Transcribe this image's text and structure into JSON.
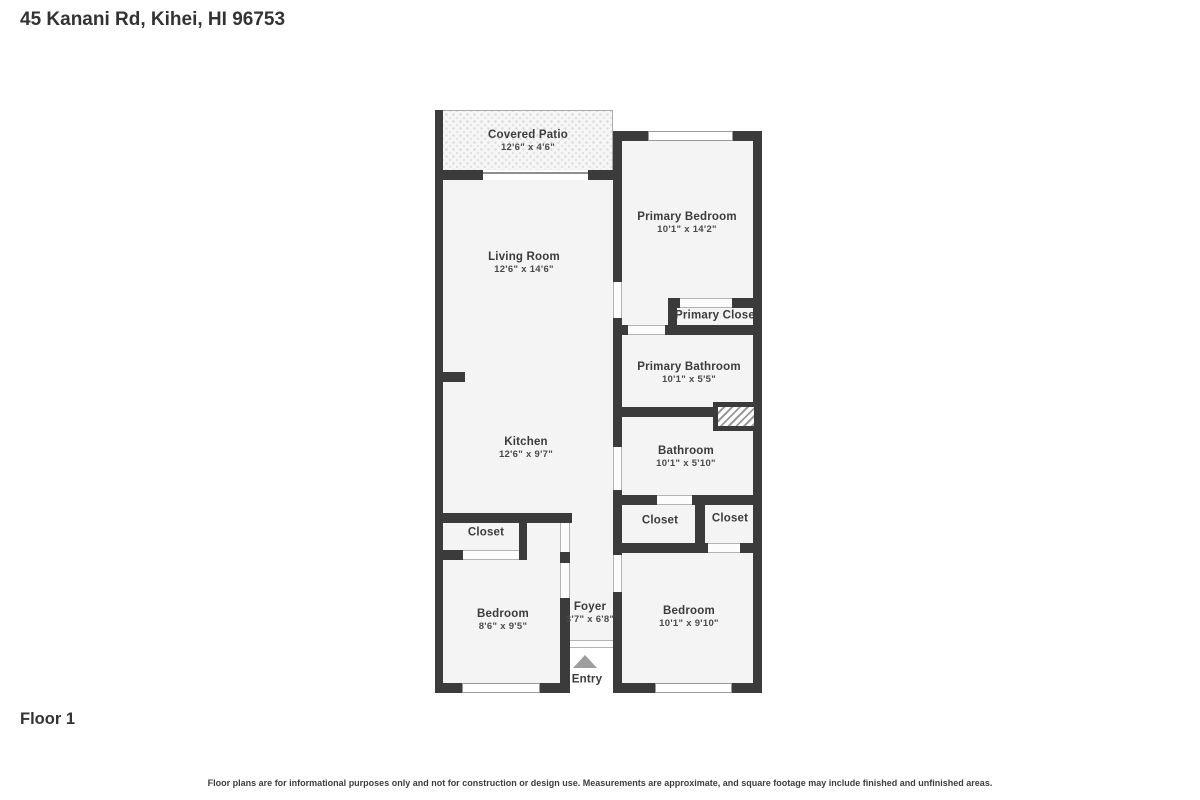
{
  "header": {
    "address": "45 Kanani Rd, Kihei, HI 96753"
  },
  "floor_label": "Floor 1",
  "entry_label": "Entry",
  "disclaimer": "Floor plans are for informational purposes only and not for construction or design use. Measurements are approximate, and square footage may include finished and unfinished areas.",
  "colors": {
    "wall": "#3b3b3b",
    "room_fill": "#f4f4f4",
    "entry_arrow": "#9e9e9e"
  },
  "rooms": [
    {
      "name": "Covered Patio",
      "dims": "12'6\" x 4'6\""
    },
    {
      "name": "Living Room",
      "dims": "12'6\" x 14'6\""
    },
    {
      "name": "Primary Bedroom",
      "dims": "10'1\" x 14'2\""
    },
    {
      "name": "Primary Closet"
    },
    {
      "name": "Primary Bathroom",
      "dims": "10'1\" x 5'5\""
    },
    {
      "name": "Kitchen",
      "dims": "12'6\" x 9'7\""
    },
    {
      "name": "Bathroom",
      "dims": "10'1\" x 5'10\""
    },
    {
      "name": "Closet"
    },
    {
      "name": "Closet"
    },
    {
      "name": "Closet"
    },
    {
      "name": "Bedroom",
      "dims": "8'6\" x 9'5\""
    },
    {
      "name": "Foyer",
      "dims": "3'7\" x 6'8\""
    },
    {
      "name": "Bedroom",
      "dims": "10'1\" x 9'10\""
    }
  ]
}
